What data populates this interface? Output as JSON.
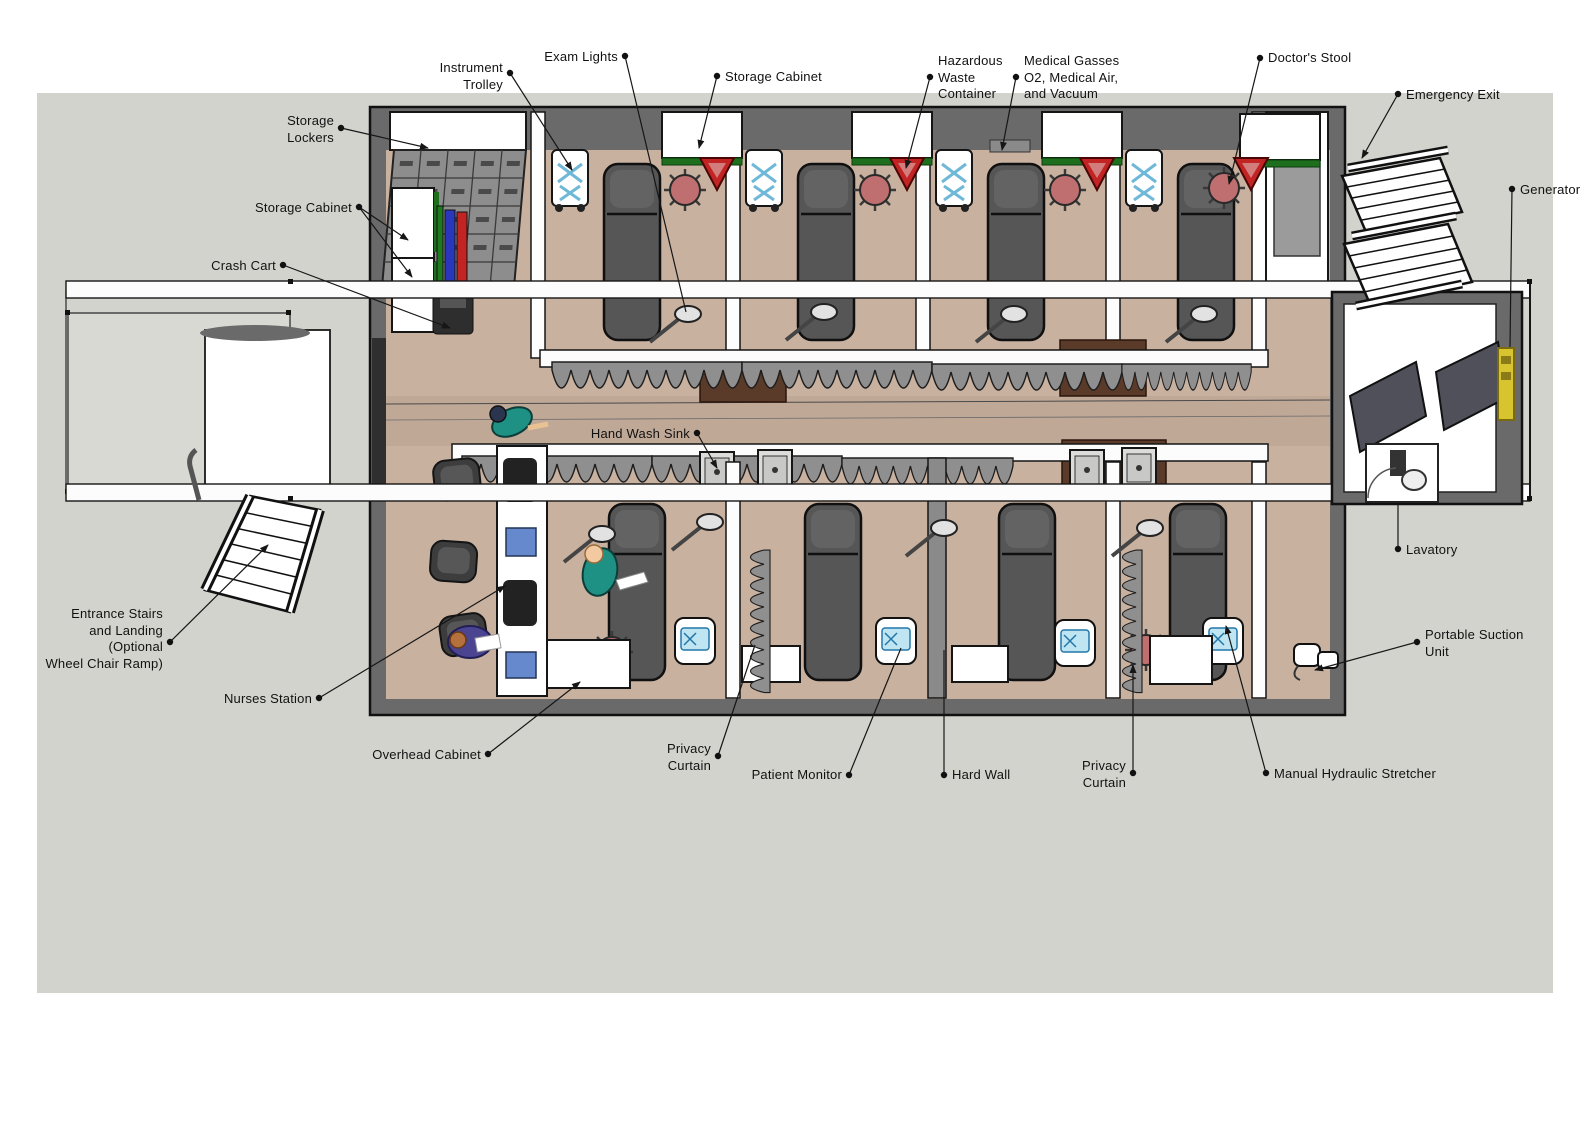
{
  "colors": {
    "ground": "#d3d3ce",
    "wall_gray": "#6a6a6a",
    "floor_tan": "#c9b1a0",
    "corridor_shade": "#c0a897",
    "stretcher_gray": "#565656",
    "stool_red": "#bf6f6f",
    "curtain_gray": "#8f8f8f",
    "scrubs_teal": "#1f9184",
    "crash_cart_blue": "#2a36bb",
    "crash_cart_red": "#c22424",
    "cabinet_green": "#1d6f1d",
    "hazard_red": "#c22424",
    "generator_yellow": "#d8c42e",
    "leader_line": "#161616"
  },
  "labels": [
    {
      "id": "instrument-trolley",
      "lines": [
        "Instrument",
        "Trolley"
      ],
      "side": "left",
      "dot": [
        510,
        73
      ],
      "text_top": 60,
      "ends": [
        [
          572,
          170
        ]
      ],
      "arrow": true
    },
    {
      "id": "exam-lights",
      "lines": [
        "Exam Lights"
      ],
      "side": "left",
      "dot": [
        625,
        56
      ],
      "text_top": 49,
      "ends": [
        [
          686,
          312
        ]
      ],
      "arrow": false
    },
    {
      "id": "storage-cabinet-top",
      "lines": [
        "Storage Cabinet"
      ],
      "side": "right",
      "dot": [
        717,
        76
      ],
      "text_top": 69,
      "ends": [
        [
          699,
          148
        ]
      ],
      "arrow": true
    },
    {
      "id": "hazardous-waste-container",
      "lines": [
        "Hazardous",
        "Waste",
        "Container"
      ],
      "side": "right",
      "dot": [
        930,
        77
      ],
      "text_top": 53,
      "ends": [
        [
          906,
          168
        ]
      ],
      "arrow": true
    },
    {
      "id": "medical-gasses",
      "lines": [
        "Medical Gasses",
        "O2, Medical Air,",
        "and Vacuum"
      ],
      "side": "right",
      "dot": [
        1016,
        77
      ],
      "text_top": 53,
      "ends": [
        [
          1002,
          150
        ]
      ],
      "arrow": true
    },
    {
      "id": "doctors-stool",
      "lines": [
        "Doctor's Stool"
      ],
      "side": "right",
      "dot": [
        1260,
        58
      ],
      "text_top": 50,
      "ends": [
        [
          1229,
          184
        ]
      ],
      "arrow": true
    },
    {
      "id": "emergency-exit",
      "lines": [
        "Emergency Exit"
      ],
      "side": "right",
      "dot": [
        1398,
        94
      ],
      "text_top": 87,
      "ends": [
        [
          1362,
          158
        ]
      ],
      "arrow": true
    },
    {
      "id": "generator",
      "lines": [
        "Generator"
      ],
      "side": "right",
      "dot": [
        1512,
        189
      ],
      "text_top": 182,
      "ends": [
        [
          1510,
          347
        ]
      ],
      "arrow": false
    },
    {
      "id": "storage-lockers",
      "lines": [
        "Storage",
        "Lockers"
      ],
      "side": "left",
      "dot": [
        341,
        128
      ],
      "text_top": 113,
      "ends": [
        [
          428,
          148
        ]
      ],
      "arrow": true
    },
    {
      "id": "storage-cabinet-left",
      "lines": [
        "Storage Cabinet"
      ],
      "side": "left",
      "dot": [
        359,
        207
      ],
      "text_top": 200,
      "ends": [
        [
          408,
          240
        ],
        [
          412,
          277
        ]
      ],
      "arrow": true
    },
    {
      "id": "crash-cart",
      "lines": [
        "Crash Cart"
      ],
      "side": "left",
      "dot": [
        283,
        265
      ],
      "text_top": 258,
      "ends": [
        [
          450,
          328
        ]
      ],
      "arrow": true
    },
    {
      "id": "hand-wash-sink",
      "lines": [
        "Hand Wash Sink"
      ],
      "side": "left",
      "dot": [
        697,
        433
      ],
      "text_top": 426,
      "ends": [
        [
          717,
          468
        ]
      ],
      "arrow": true
    },
    {
      "id": "lavatory",
      "lines": [
        "Lavatory"
      ],
      "side": "right",
      "dot": [
        1398,
        549
      ],
      "text_top": 542,
      "ends": [
        [
          1398,
          503
        ]
      ],
      "arrow": false
    },
    {
      "id": "entrance-stairs",
      "lines": [
        "Entrance Stairs",
        "and Landing",
        "(Optional",
        "Wheel Chair Ramp)"
      ],
      "side": "left",
      "dot": [
        170,
        642
      ],
      "text_top": 606,
      "ends": [
        [
          268,
          545
        ]
      ],
      "arrow": true
    },
    {
      "id": "nurses-station",
      "lines": [
        "Nurses Station"
      ],
      "side": "left",
      "dot": [
        319,
        698
      ],
      "text_top": 691,
      "ends": [
        [
          505,
          586
        ]
      ],
      "arrow": true
    },
    {
      "id": "overhead-cabinet",
      "lines": [
        "Overhead Cabinet"
      ],
      "side": "left",
      "dot": [
        488,
        754
      ],
      "text_top": 747,
      "ends": [
        [
          580,
          682
        ]
      ],
      "arrow": true
    },
    {
      "id": "privacy-curtain-left",
      "lines": [
        "Privacy",
        "Curtain"
      ],
      "side": "left",
      "dot": [
        718,
        756
      ],
      "text_top": 741,
      "ends": [
        [
          755,
          645
        ]
      ],
      "arrow": false
    },
    {
      "id": "patient-monitor",
      "lines": [
        "Patient Monitor"
      ],
      "side": "left",
      "dot": [
        849,
        775
      ],
      "text_top": 767,
      "ends": [
        [
          901,
          648
        ]
      ],
      "arrow": false
    },
    {
      "id": "hard-wall",
      "lines": [
        "Hard Wall"
      ],
      "side": "right",
      "dot": [
        944,
        775
      ],
      "text_top": 767,
      "ends": [
        [
          944,
          650
        ]
      ],
      "arrow": false
    },
    {
      "id": "privacy-curtain-right",
      "lines": [
        "Privacy",
        "Curtain"
      ],
      "side": "left",
      "dot": [
        1133,
        773
      ],
      "text_top": 758,
      "ends": [
        [
          1133,
          665
        ]
      ],
      "arrow": true
    },
    {
      "id": "manual-hydraulic-stretcher",
      "lines": [
        "Manual Hydraulic Stretcher"
      ],
      "side": "right",
      "dot": [
        1266,
        773
      ],
      "text_top": 766,
      "ends": [
        [
          1226,
          626
        ]
      ],
      "arrow": true
    },
    {
      "id": "portable-suction-unit",
      "lines": [
        "Portable Suction",
        "Unit"
      ],
      "side": "right",
      "dot": [
        1417,
        642
      ],
      "text_top": 627,
      "ends": [
        [
          1315,
          670
        ]
      ],
      "arrow": true
    }
  ]
}
